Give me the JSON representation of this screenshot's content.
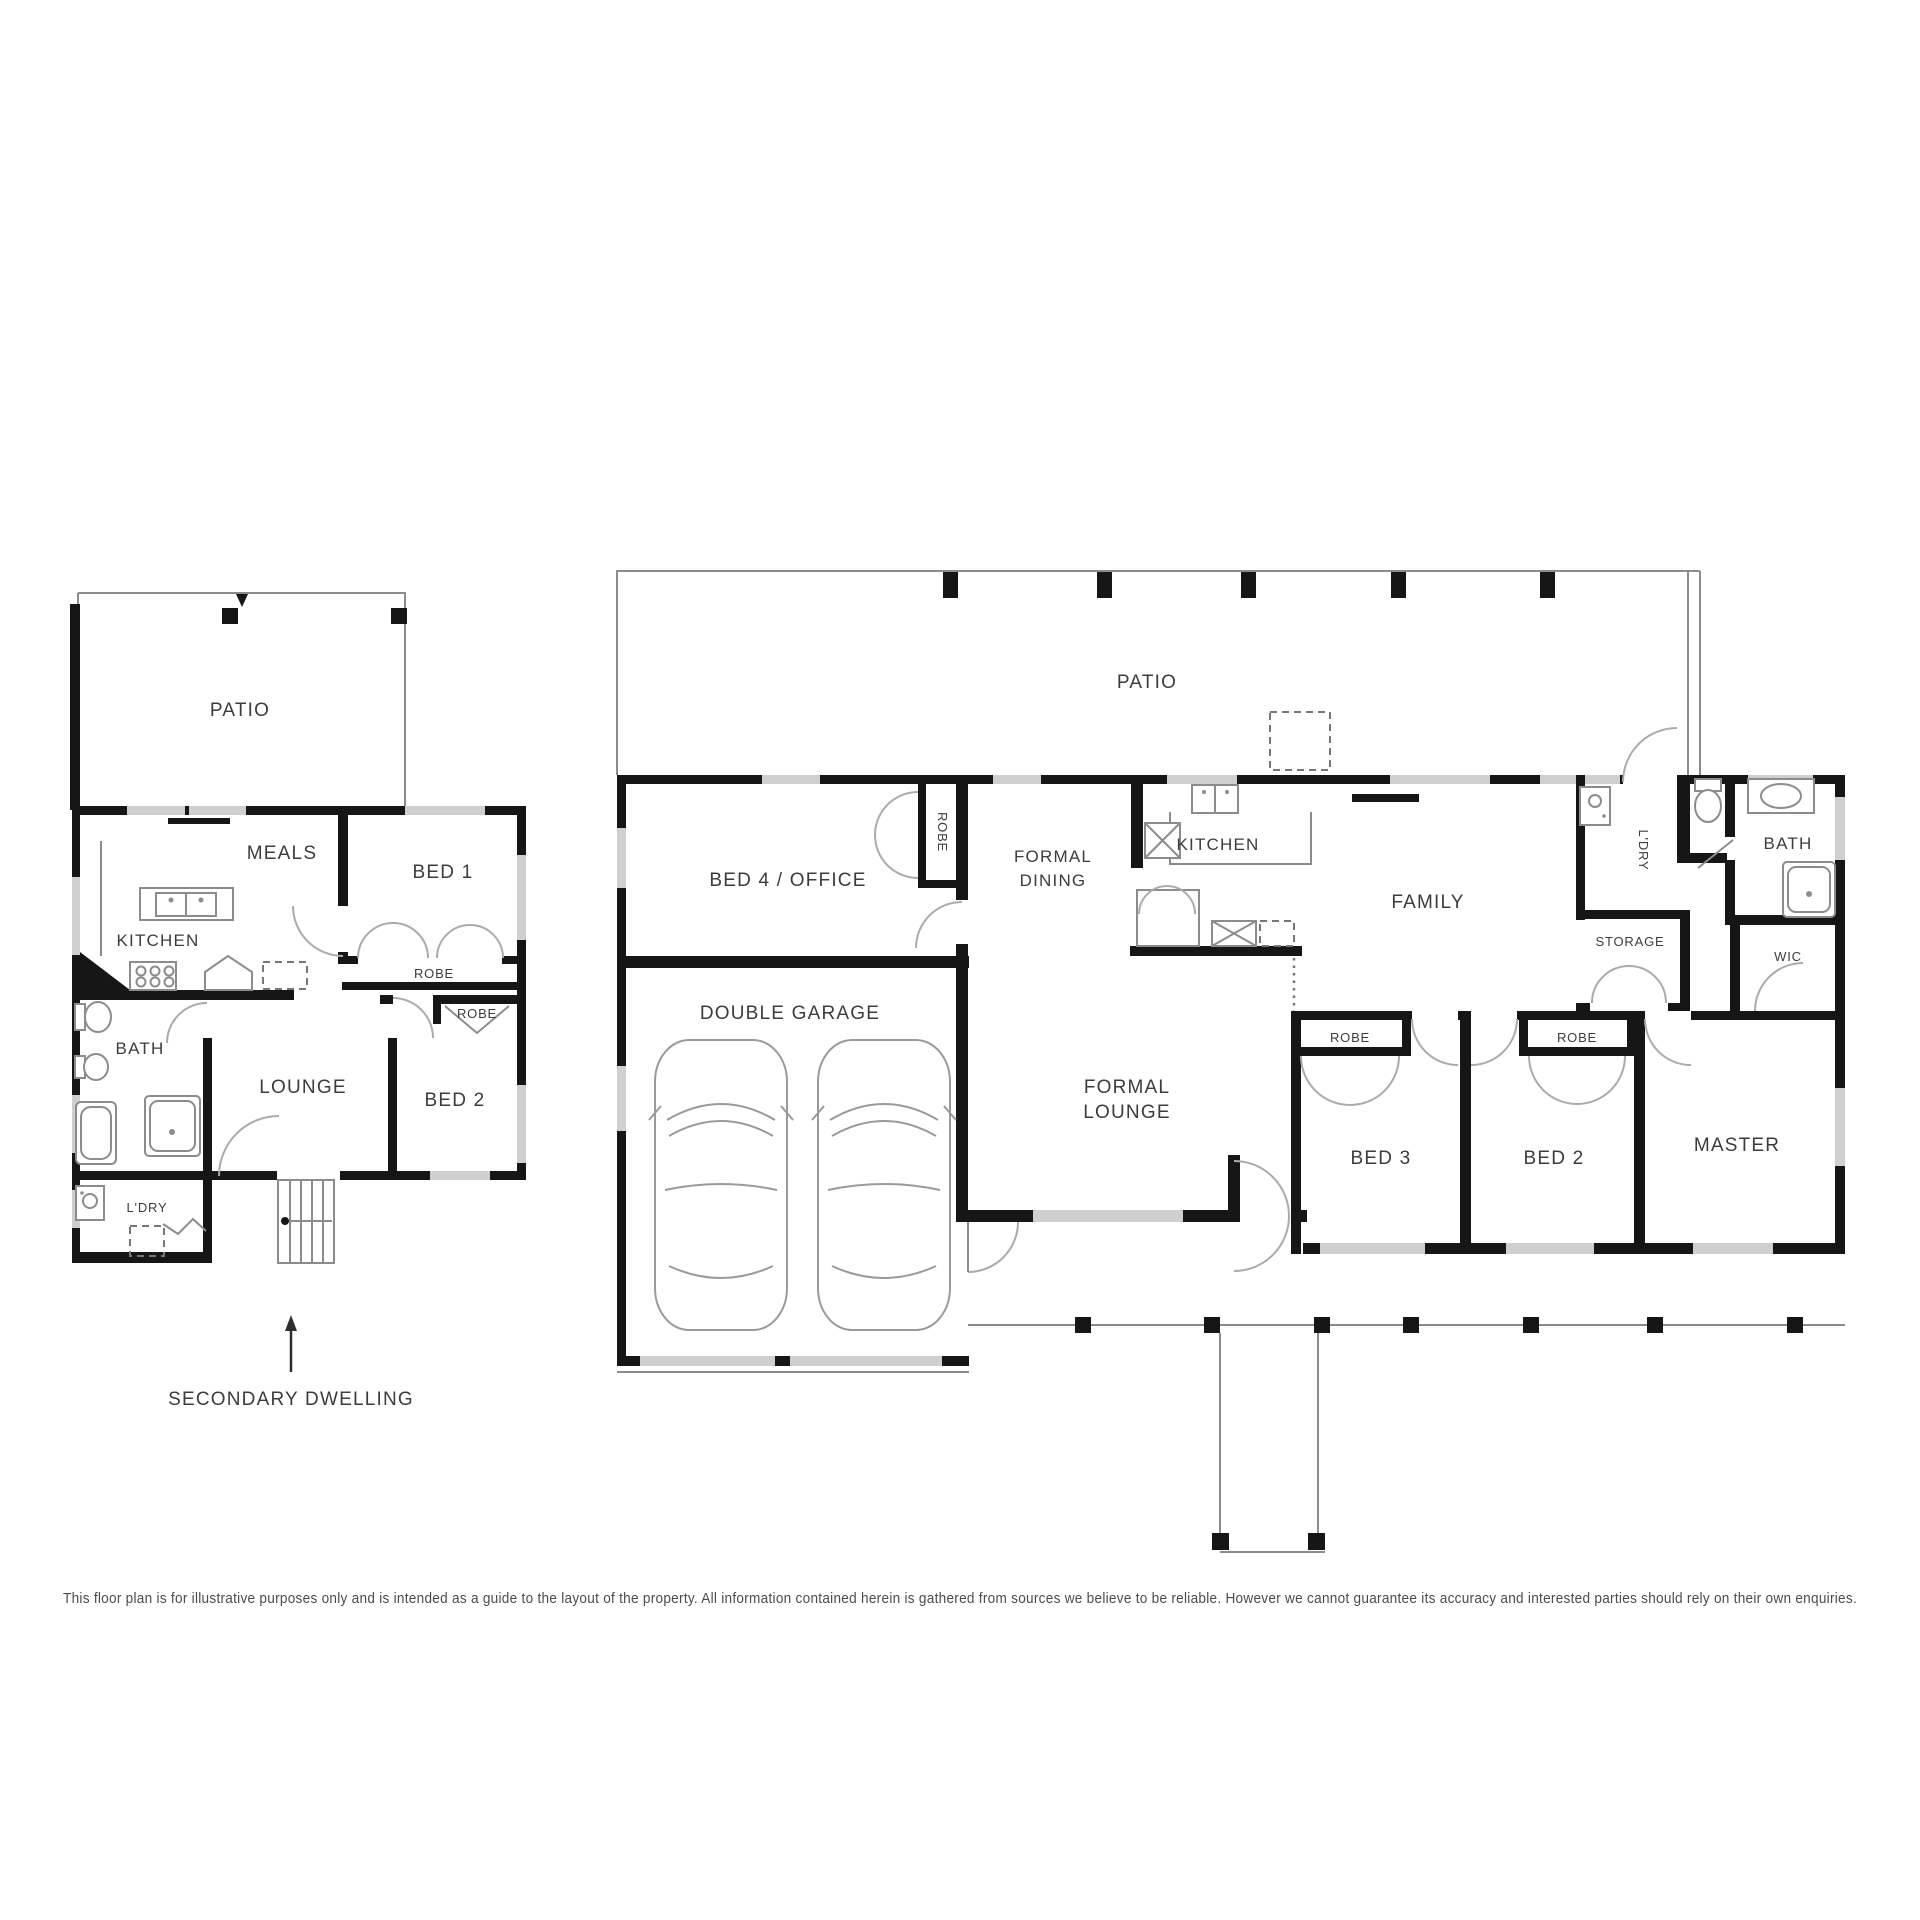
{
  "secondary": {
    "patio": "PATIO",
    "meals": "MEALS",
    "bed1": "BED 1",
    "kitchen": "KITCHEN",
    "robe_bed1": "ROBE",
    "robe_bed2": "ROBE",
    "bath": "BATH",
    "lounge": "LOUNGE",
    "bed2": "BED 2",
    "laundry": "L'DRY",
    "caption": "SECONDARY DWELLING"
  },
  "main": {
    "patio": "PATIO",
    "bed4_office": "BED 4 / OFFICE",
    "robe_bed4": "ROBE",
    "formal_dining": [
      "FORMAL",
      "DINING"
    ],
    "kitchen": "KITCHEN",
    "family": "FAMILY",
    "laundry": "L'DRY",
    "bath": "BATH",
    "storage": "STORAGE",
    "wic": "WIC",
    "double_garage": "DOUBLE GARAGE",
    "formal_lounge": [
      "FORMAL",
      "LOUNGE"
    ],
    "robe_bed3": "ROBE",
    "robe_bed2": "ROBE",
    "bed3": "BED 3",
    "bed2": "BED 2",
    "master": "MASTER"
  },
  "disclaimer": "This floor plan is for illustrative purposes only and is intended as a guide to the layout of the property. All information contained herein is gathered from sources we believe to be reliable. However we cannot guarantee its accuracy and interested parties should rely on their own enquiries.",
  "colors": {
    "wall": "#161616",
    "window": "#cfcfcf",
    "line": "#8c8c8c",
    "text": "#3c3c3c"
  }
}
